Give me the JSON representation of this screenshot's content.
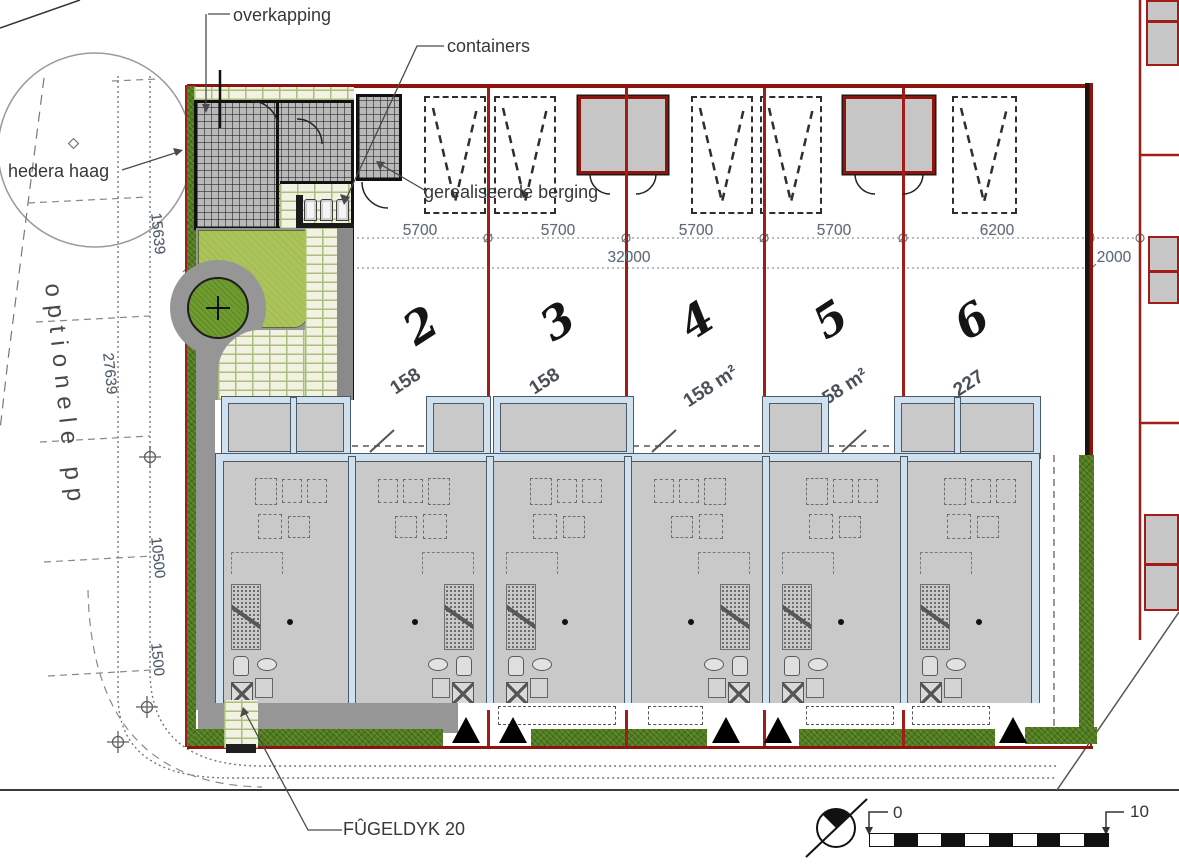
{
  "annotations": {
    "overkapping": "overkapping",
    "containers": "containers",
    "hedera_haag": "hedera haag",
    "gerealiseerde_berging": "gerealiseerde berging",
    "street": "FÛGELDYK 20",
    "optionele_pp": "optionele pp"
  },
  "dimensions": {
    "plot_widths": [
      "5700",
      "5700",
      "5700",
      "5700",
      "6200"
    ],
    "total_width": "32000",
    "right_offset": "2000",
    "left_chain": [
      "15639",
      "27639",
      "10500",
      "1500"
    ]
  },
  "plots": [
    {
      "number": "2",
      "area": "158"
    },
    {
      "number": "3",
      "area": "158"
    },
    {
      "number": "4",
      "area": "158 m²"
    },
    {
      "number": "5",
      "area": "158 m²"
    },
    {
      "number": "6",
      "area": "227"
    }
  ],
  "scale_bar": {
    "start": "0",
    "end": "10"
  },
  "colors": {
    "boundary_red": "#a21d1a",
    "hedge_green": "#4e7a1c",
    "lawn_green": "#abc459",
    "tree_green": "#6f9c2e",
    "wall_blue": "#cfe0ee",
    "floor_grey": "#c9c9c9",
    "brick_joint": "#a9bf7e"
  }
}
